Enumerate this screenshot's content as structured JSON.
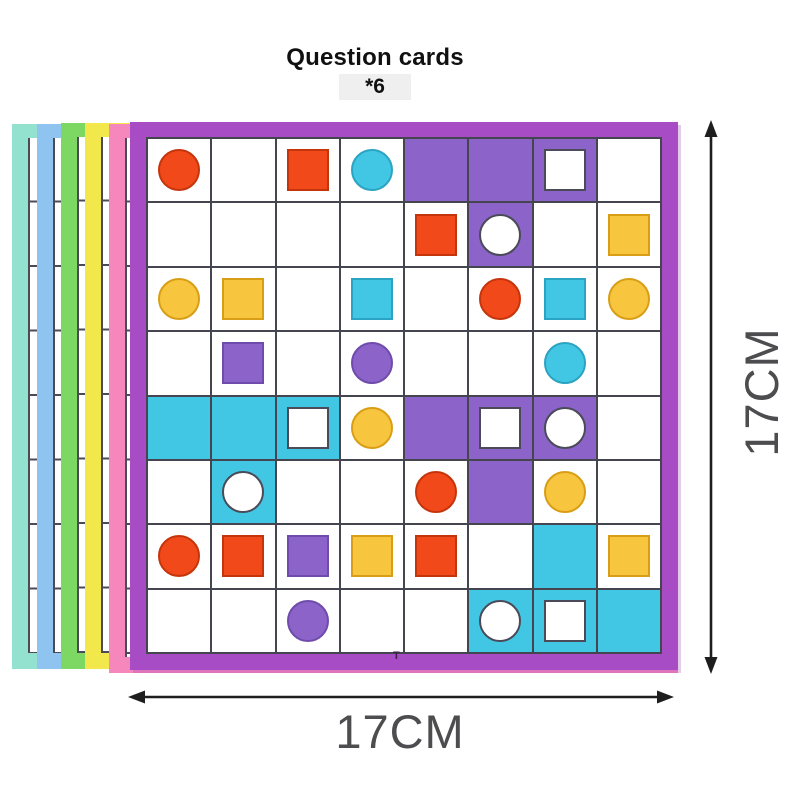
{
  "title": {
    "line1": "Question cards",
    "line2": "*6"
  },
  "dims": {
    "width_label": "17CM",
    "height_label": "17CM"
  },
  "marks": {
    "t": "T"
  },
  "colors": {
    "card_border_purple": "#A84CC6",
    "grid_line": "#45454f",
    "cell_bg": {
      "w": "#ffffff",
      "p": "#8B63C9",
      "c": "#41C7E4"
    },
    "shape_fill": {
      "red": "#F2491B",
      "yellow": "#F8C53E",
      "cyan": "#41C7E4",
      "purple": "#8B63C9",
      "white": "#ffffff"
    },
    "shape_stroke": {
      "red": "#C5350C",
      "yellow": "#D89E15",
      "cyan": "#2BA3C2",
      "purple": "#6F4BAB",
      "white": "#4A4A58"
    },
    "arrow": "#1e1e1e",
    "dim_label": "#4d4d50"
  },
  "stack_cards": [
    {
      "id": "card-mint",
      "name": "mint-card",
      "color": "#93E2CF"
    },
    {
      "id": "card-blue",
      "name": "blue-card",
      "color": "#8FC3F0"
    },
    {
      "id": "card-green",
      "name": "green-card",
      "color": "#7CD862"
    },
    {
      "id": "card-yellow",
      "name": "yellow-card",
      "color": "#F2E84B"
    },
    {
      "id": "card-pink",
      "name": "pink-card",
      "color": "#F687BC"
    }
  ],
  "grid": {
    "rows": 8,
    "cols": 8,
    "cell_token_format": "bg:shape:fill  (bg w=white p=purple c=cyan; shape o=circle s=square)",
    "cells": [
      [
        "w:o:red",
        "w",
        "w:s:red",
        "w:o:cyan",
        "p",
        "p",
        "p:s:white",
        "w"
      ],
      [
        "w",
        "w",
        "w",
        "w",
        "w:s:red",
        "p:o:white",
        "w",
        "w:s:yellow"
      ],
      [
        "w:o:yellow",
        "w:s:yellow",
        "w",
        "w:s:cyan",
        "w",
        "w:o:red",
        "w:s:cyan",
        "w:o:yellow"
      ],
      [
        "w",
        "w:s:purple",
        "w",
        "w:o:purple",
        "w",
        "w",
        "w:o:cyan",
        "w"
      ],
      [
        "c",
        "c",
        "c:s:white",
        "w:o:yellow",
        "p",
        "p:s:white",
        "p:o:white",
        "w"
      ],
      [
        "w",
        "c:o:white",
        "w",
        "w",
        "w:o:red",
        "p",
        "w:o:yellow",
        "w"
      ],
      [
        "w:o:red",
        "w:s:red",
        "w:s:purple",
        "w:s:yellow",
        "w:s:red",
        "w",
        "c",
        "w:s:yellow"
      ],
      [
        "w",
        "w",
        "w:o:purple",
        "w",
        "w",
        "c:o:white",
        "c:s:white",
        "c"
      ]
    ]
  }
}
